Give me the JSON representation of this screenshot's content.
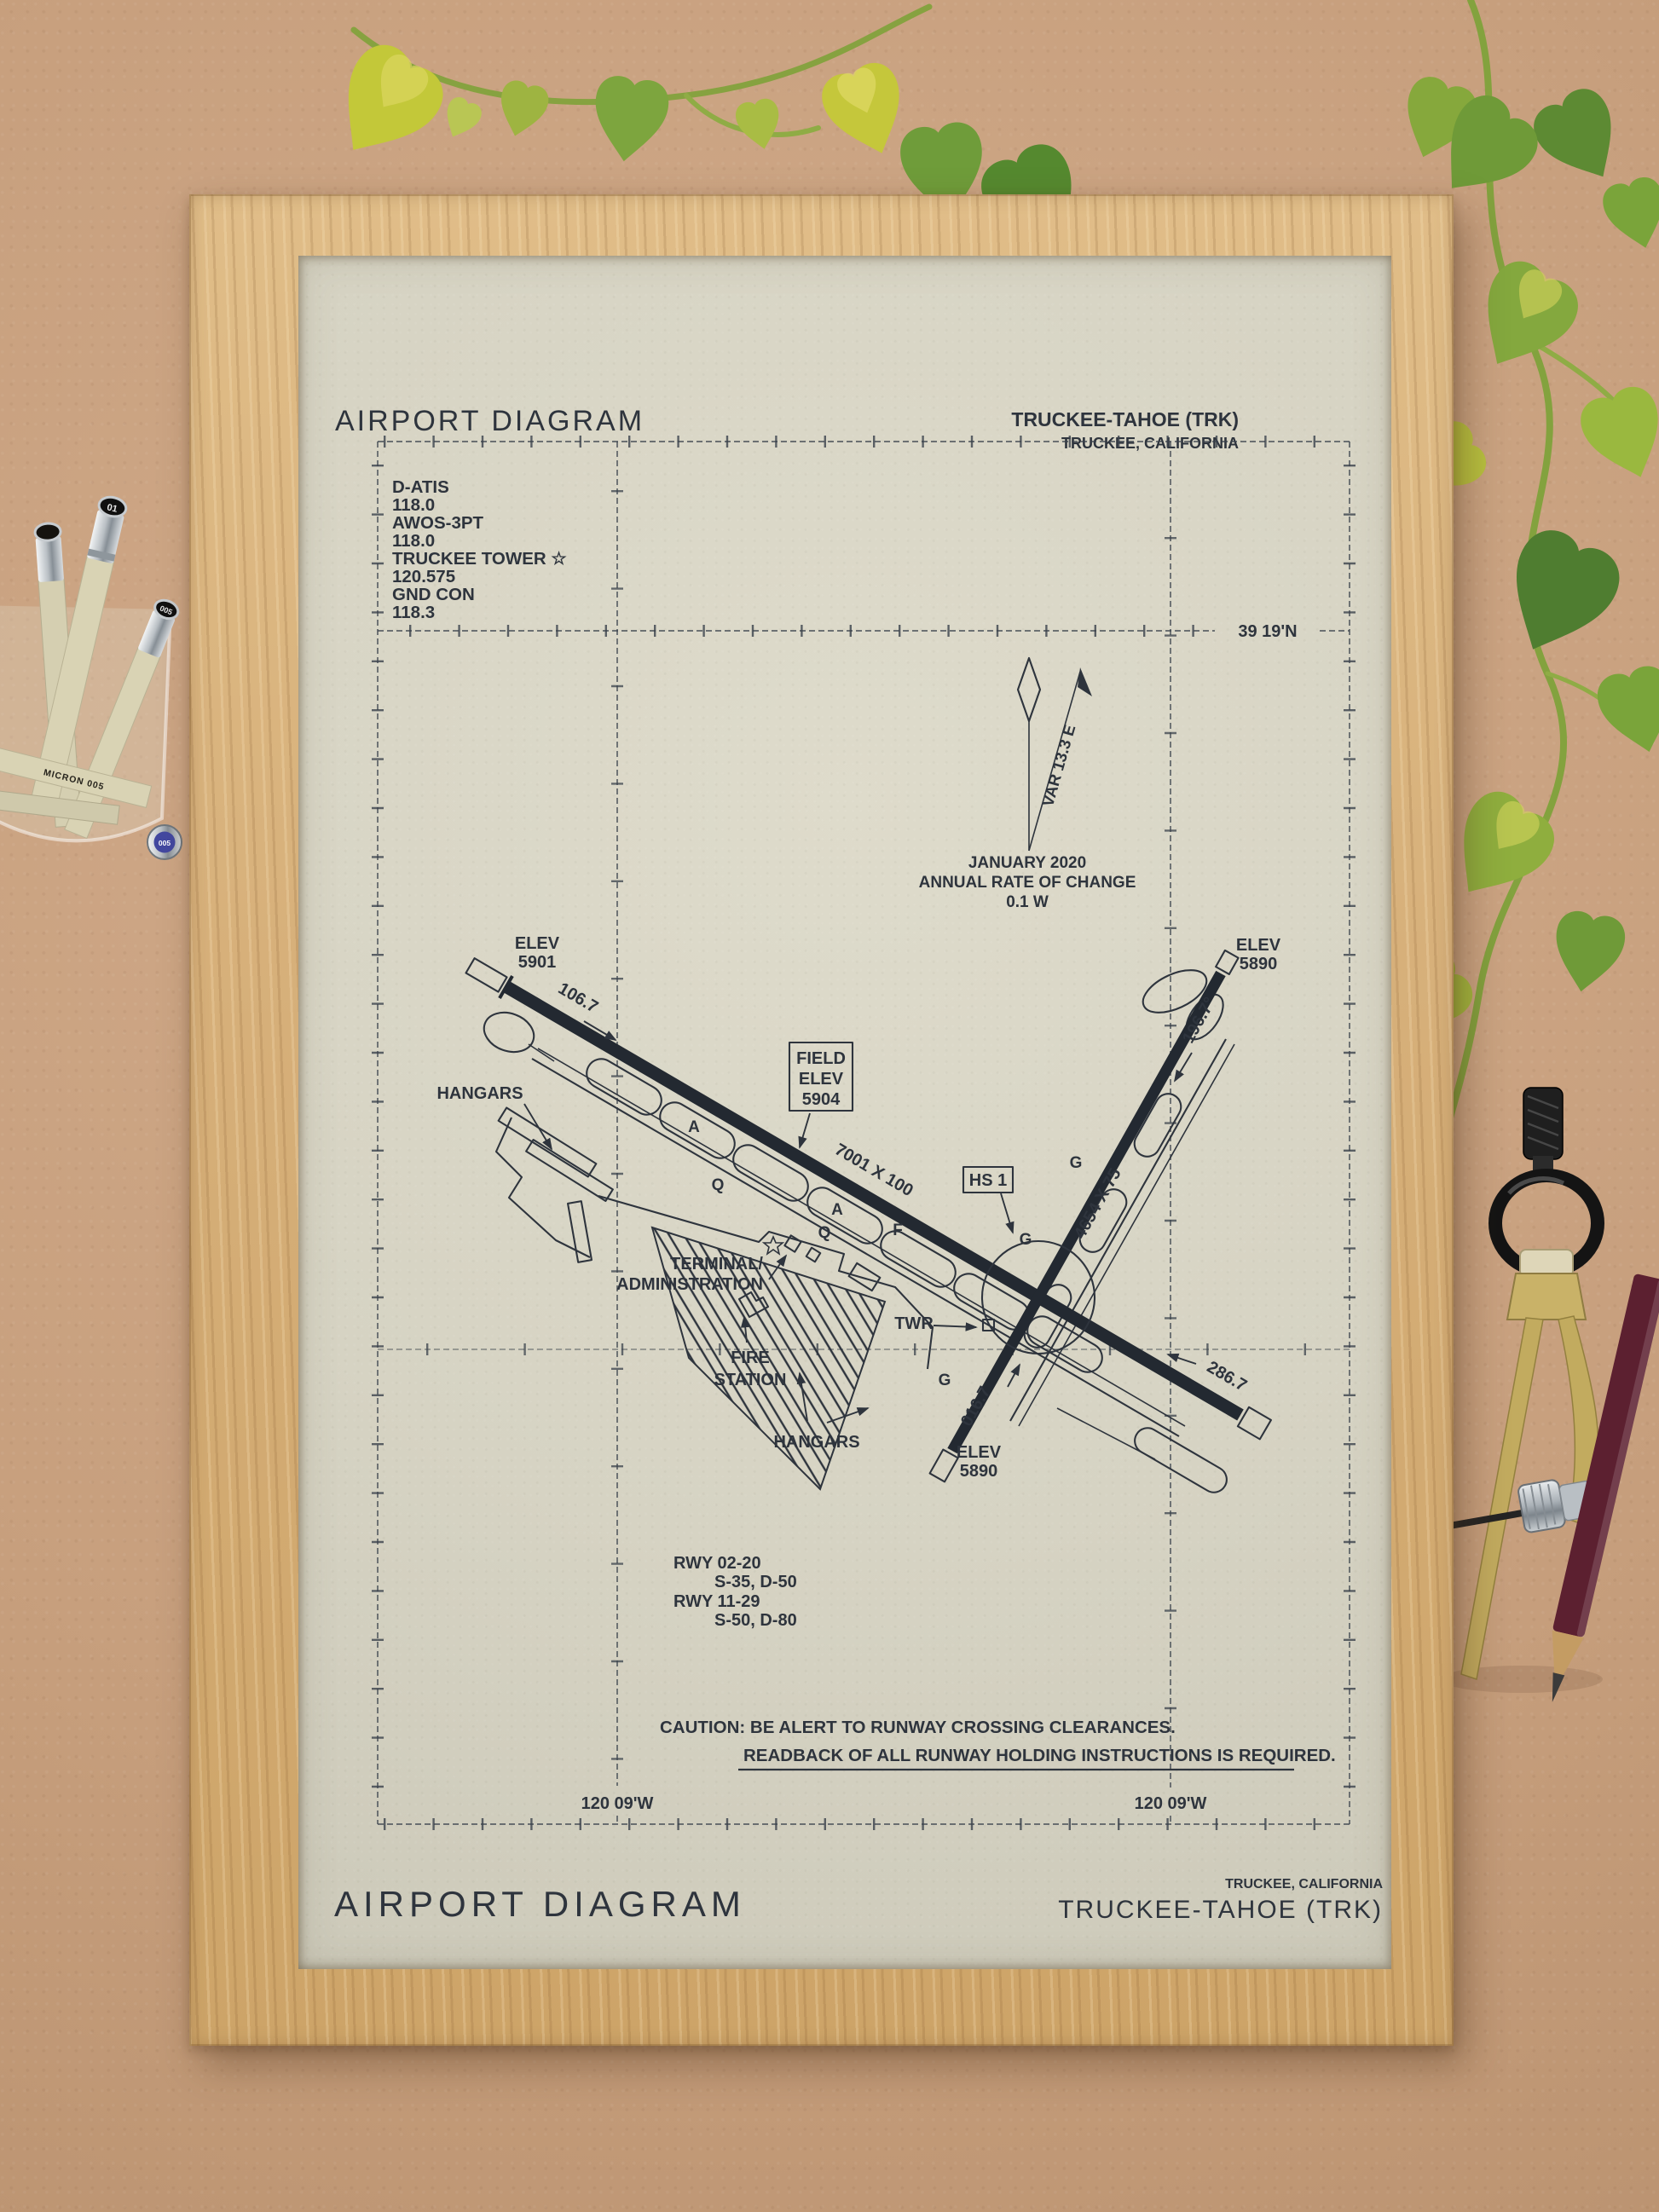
{
  "scene": {
    "pens": {
      "cap_small": "01",
      "cap_mid": "005",
      "cap_blue": "005",
      "body_label": "MICRON 005"
    },
    "colors": {
      "board": "#c79f7d",
      "frame_oak": "#d6af79",
      "paper": "#d6d3c3",
      "ink": "#2e343d",
      "plant_green": "#7da53e",
      "compass_brass": "#c2ab5f",
      "pencil_maroon": "#5c2030"
    }
  },
  "poster": {
    "header": {
      "title": "AIRPORT DIAGRAM",
      "airport": "TRUCKEE-TAHOE (TRK)",
      "city": "TRUCKEE, CALIFORNIA"
    },
    "frequencies": [
      "D-ATIS",
      "118.0",
      "AWOS-3PT",
      "118.0",
      "TRUCKEE TOWER ☆",
      "120.575",
      "GND CON",
      "118.3"
    ],
    "grid": {
      "lat_label": "39 19'N",
      "lon_label_left": "120 09'W",
      "lon_label_right": "120 09'W"
    },
    "north": {
      "variation": "VAR 13.3 E",
      "date": "JANUARY 2020",
      "rate_caption": "ANNUAL RATE OF CHANGE",
      "rate_value": "0.1  W"
    },
    "labels": {
      "elev_nw": "ELEV",
      "elev_nw_value": "5901",
      "hdg_11": "106.7",
      "hangars_nw": "HANGARS",
      "field_elev_1": "FIELD",
      "field_elev_2": "ELEV",
      "field_elev_3": "5904",
      "rwy_11_29_size": "7001 X 100",
      "hot_spot": "HS 1",
      "rwy_02_20_size": "4654 X 75",
      "elev_ne": "ELEV",
      "elev_ne_value": "5890",
      "hdg_20": "196.7°",
      "terminal_1": "TERMINAL/",
      "terminal_2": "ADMINISTRATION",
      "tower": "TWR",
      "fire_1": "FIRE",
      "fire_2": "STATION",
      "hangars_s": "HANGARS",
      "hdg_2": "016.7",
      "elev_s": "ELEV",
      "elev_s_value": "5890",
      "hdg_29": "286.7"
    },
    "taxiway_labels": [
      "A",
      "Q",
      "A",
      "Q",
      "F",
      "G",
      "G",
      "G"
    ],
    "runway_data": [
      "RWY 02-20",
      "S-35, D-50",
      "RWY 11-29",
      "S-50, D-80"
    ],
    "caution": {
      "line1": "CAUTION: BE ALERT TO RUNWAY CROSSING CLEARANCES.",
      "line2": "READBACK OF ALL RUNWAY HOLDING INSTRUCTIONS IS REQUIRED."
    },
    "footer": {
      "title": "AIRPORT DIAGRAM",
      "city": "TRUCKEE, CALIFORNIA",
      "airport": "TRUCKEE-TAHOE (TRK)"
    }
  }
}
